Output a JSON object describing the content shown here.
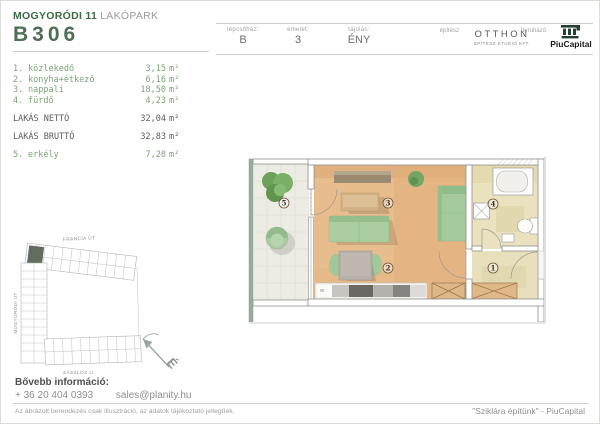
{
  "header": {
    "project_bold": "MOGYORÓDI 11",
    "project_light": "LAKÓPARK",
    "unit_id": "B306",
    "staircase_label": "lépcsőház:",
    "staircase_value": "B",
    "floor_label": "emelet:",
    "floor_value": "3",
    "orientation_label": "tájolás:",
    "orientation_value": "ÉNY",
    "architect_label": "építész",
    "architect_name": "OTTHON",
    "architect_sub": "ÉPÍTÉSZ STÚDIÓ KFT.",
    "developer_label": "beruházó",
    "developer_name": "PiuCapital"
  },
  "rooms": [
    {
      "num": "1.",
      "name": "közlekedő",
      "area": "3,15",
      "unit": "m²"
    },
    {
      "num": "2.",
      "name": "konyha+étkező",
      "area": "6,16",
      "unit": "m²"
    },
    {
      "num": "3.",
      "name": "nappali",
      "area": "18,50",
      "unit": "m²"
    },
    {
      "num": "4.",
      "name": "fürdő",
      "area": "4,23",
      "unit": "m²"
    }
  ],
  "totals": [
    {
      "name": "LAKÁS NETTÓ",
      "area": "32,04",
      "unit": "m²"
    },
    {
      "name": "LAKÁS BRUTTÓ",
      "area": "32,83",
      "unit": "m²"
    }
  ],
  "balcony_row": {
    "num": "5.",
    "name": "erkély",
    "area": "7,28",
    "unit": "m²"
  },
  "floor_plan": {
    "label_1": "1",
    "label_2": "2",
    "label_3": "3",
    "label_4": "4",
    "label_5": "5"
  },
  "site_map": {
    "street_top": "FRANCIA ÚT",
    "street_left": "MOGYORÓDI ÚT",
    "street_bottom": "ZÁSZLÓS U.",
    "compass_letter": "É"
  },
  "footer": {
    "info_heading": "Bővebb információ:",
    "phone": "+ 36 20 404 0393",
    "email": "sales@planity.hu",
    "disclaimer": "Az ábrázolt berendezés csak illusztráció, az adatok tájékoztató jellegűek.",
    "slogan": "\"Sziklára építünk\" - PiuCapital"
  },
  "colors": {
    "accent_green": "#3c6b43",
    "list_green": "#7ca377",
    "wood_floor": "#e8bd8d",
    "tile_beige": "#eae2bf",
    "furniture_green": "#aacea0",
    "logo_green": "#24402e"
  }
}
